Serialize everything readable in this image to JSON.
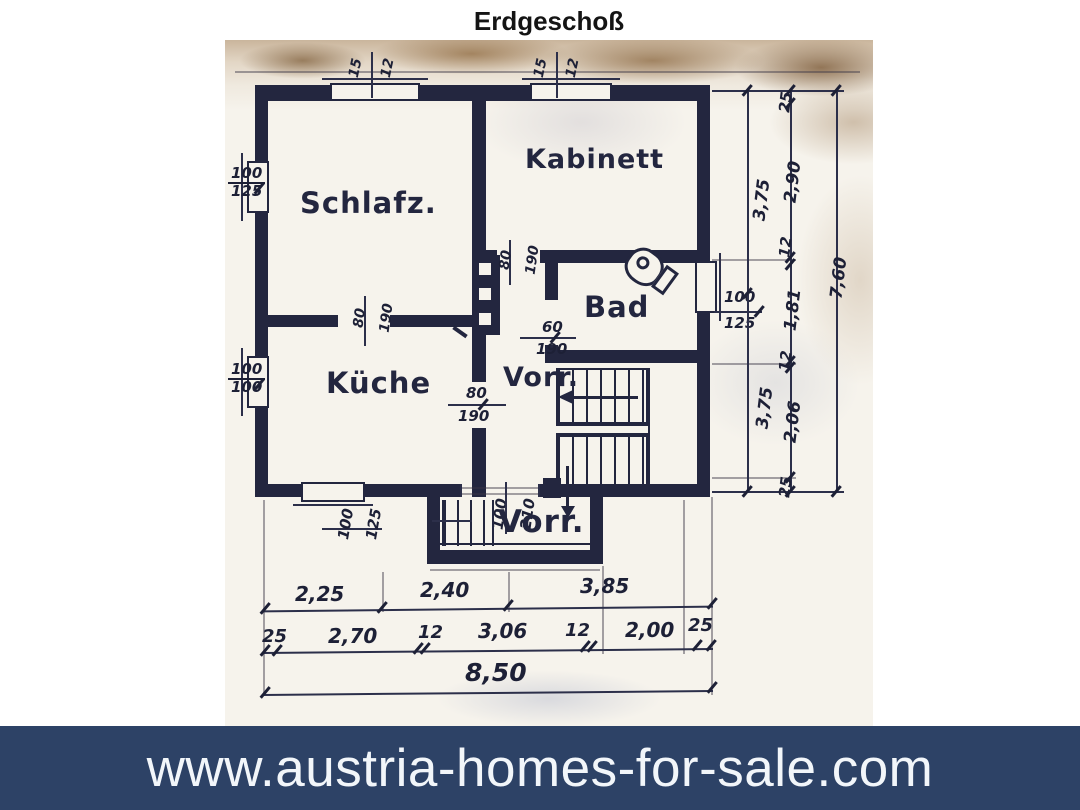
{
  "plan": {
    "title": "Erdgeschoß",
    "rooms": {
      "schlafzimmer": "Schlafz.",
      "kabinett": "Kabinett",
      "bad": "Bad",
      "kueche": "Küche",
      "vorraum_upper": "Vorr.",
      "vorraum_lower": "Vorr."
    },
    "window_labels": {
      "top_left": [
        "15",
        "12"
      ],
      "top_right": [
        "15",
        "12"
      ],
      "left_schlafz": [
        "100",
        "125"
      ],
      "left_kueche": [
        "100",
        "100"
      ],
      "right_bad": [
        "100",
        "125"
      ],
      "bottom_kueche": [
        "100",
        "125"
      ],
      "entrance_door": [
        "100",
        "210"
      ]
    },
    "door_labels": {
      "kabinett_corridor": [
        "80",
        "190"
      ],
      "bad_door": [
        "60",
        "190"
      ],
      "schlafz_kueche": [
        "80",
        "190"
      ],
      "kueche_vorraum": [
        "80",
        "190"
      ]
    },
    "dims": {
      "right_inner": [
        "3,75",
        "3,75"
      ],
      "right_detail": [
        "25",
        "2,90",
        "12",
        "1,81",
        "12",
        "2,06",
        "25"
      ],
      "right_total": "7,60",
      "bottom_rooms": [
        "2,25",
        "2,40",
        "3,85"
      ],
      "bottom_detail": [
        "25",
        "2,70",
        "12",
        "3,06",
        "12",
        "2,00",
        "25"
      ],
      "bottom_total": "8,50"
    }
  },
  "banner": {
    "url_text": "www.austria-homes-for-sale.com"
  },
  "colors": {
    "banner_bg": "#2d4266",
    "ink": "#23263f",
    "paper": "#f6f3ec",
    "scan_edge_tan": "#a98d6d"
  }
}
